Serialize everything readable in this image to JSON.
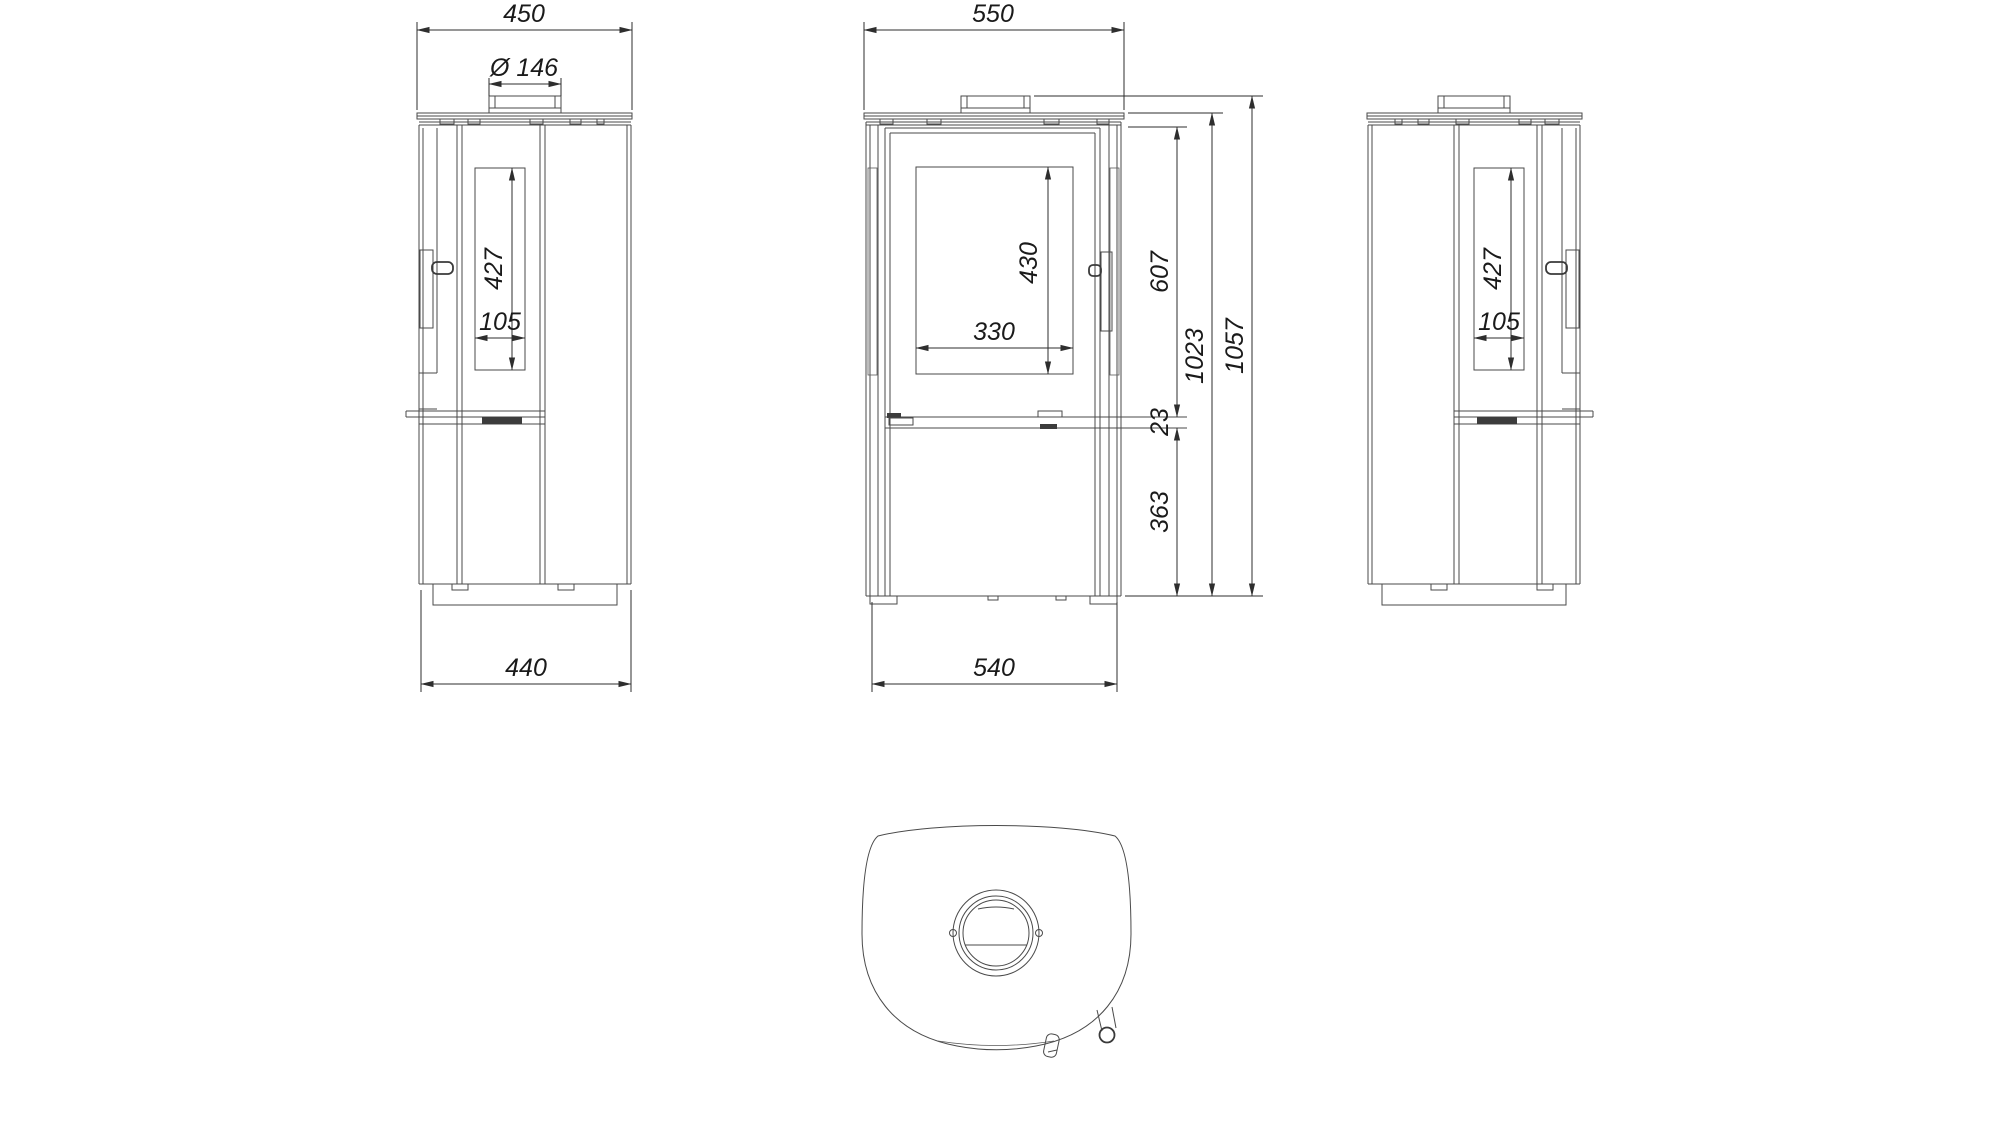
{
  "drawing": {
    "background": "#ffffff",
    "line_color": "#4a4a4a",
    "dim_color": "#2e2e2e",
    "text_color": "#1a1a1a",
    "views": {
      "side_left": {
        "dims": {
          "top_width": "450",
          "flue_diameter": "Ø 146",
          "glass_height": "427",
          "glass_width": "105",
          "base_depth": "440"
        }
      },
      "front": {
        "dims": {
          "top_width": "550",
          "glass_height": "430",
          "glass_width": "330",
          "firebox_height": "607",
          "gap": "23",
          "lower_height": "363",
          "body_height": "1023",
          "total_height": "1057",
          "base_width": "540"
        }
      },
      "side_right": {
        "dims": {
          "glass_height": "427",
          "glass_width": "105"
        }
      }
    }
  }
}
